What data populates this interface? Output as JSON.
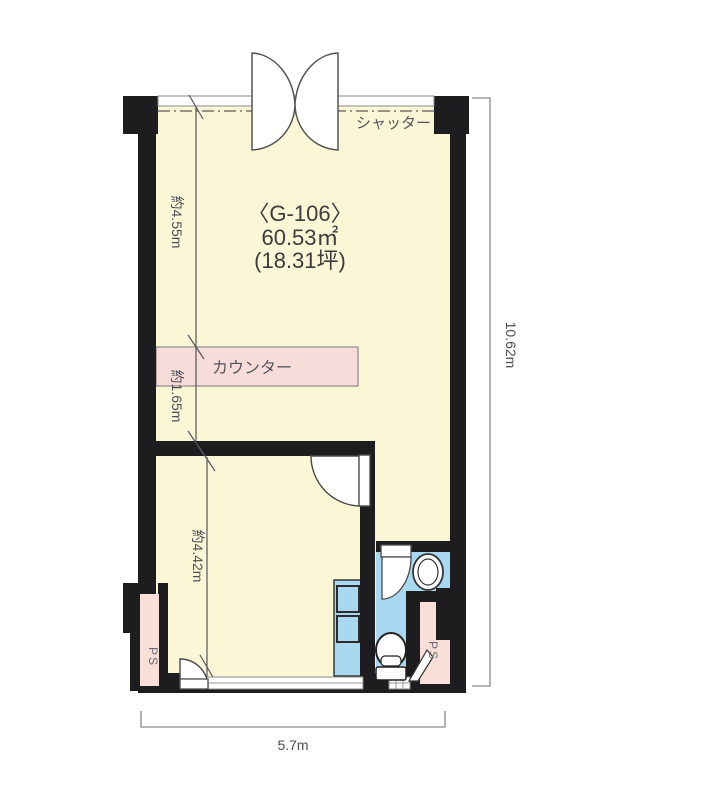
{
  "floorplan": {
    "room_id": "〈G-106〉",
    "area_m2": "60.53㎡",
    "area_tsubo": "(18.31坪)",
    "shutter": "シャッター",
    "counter": "カウンター",
    "ps_left": "PS",
    "ps_right": "PS",
    "dims": {
      "upper": "約4.55m",
      "counter_zone": "約1.65m",
      "lower": "約4.42m",
      "total_height": "10.62m",
      "total_width": "5.7m"
    },
    "colors": {
      "room": "#FAF6D6",
      "water": "#A9D9F0",
      "counter": "#F8DCDA",
      "ps": "#F9DFD7",
      "wall": "#1D1D1F"
    }
  }
}
